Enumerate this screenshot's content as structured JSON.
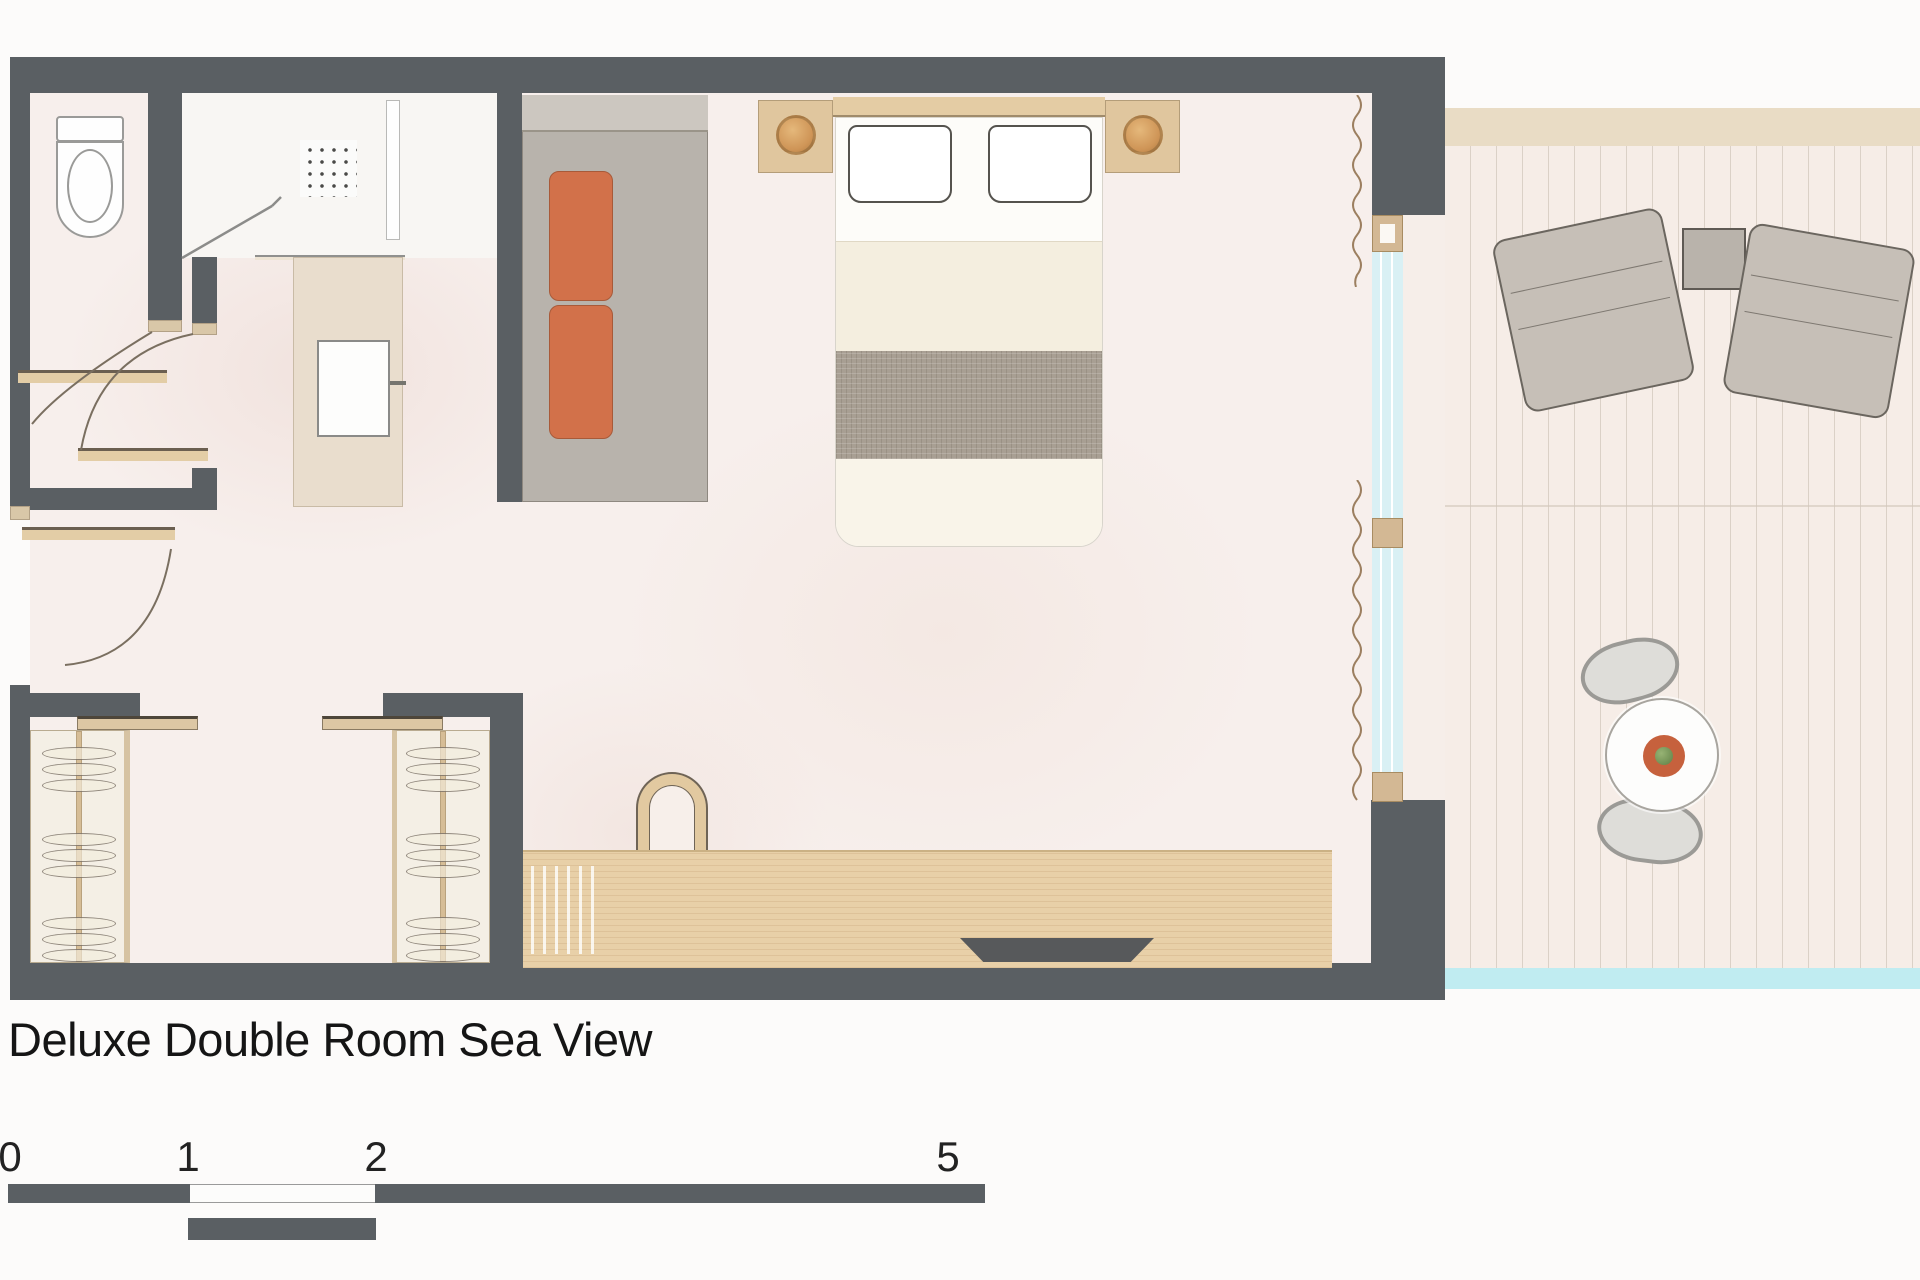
{
  "title": "Deluxe Double Room Sea View",
  "scale_bar": {
    "labels": [
      "0",
      "1",
      "2",
      "5"
    ]
  },
  "colors": {
    "wall": "#5a5f63",
    "wood_light": "#e8d0a8",
    "wood_mid": "#e3cda6",
    "accent_orange": "#d2714a",
    "sofa_gray": "#b8b3ac",
    "glass_blue": "#d9f0f4",
    "sea_cyan": "#c0ecf1",
    "floor_pink": "#f7efec",
    "deck_cream": "#f6ede7"
  }
}
